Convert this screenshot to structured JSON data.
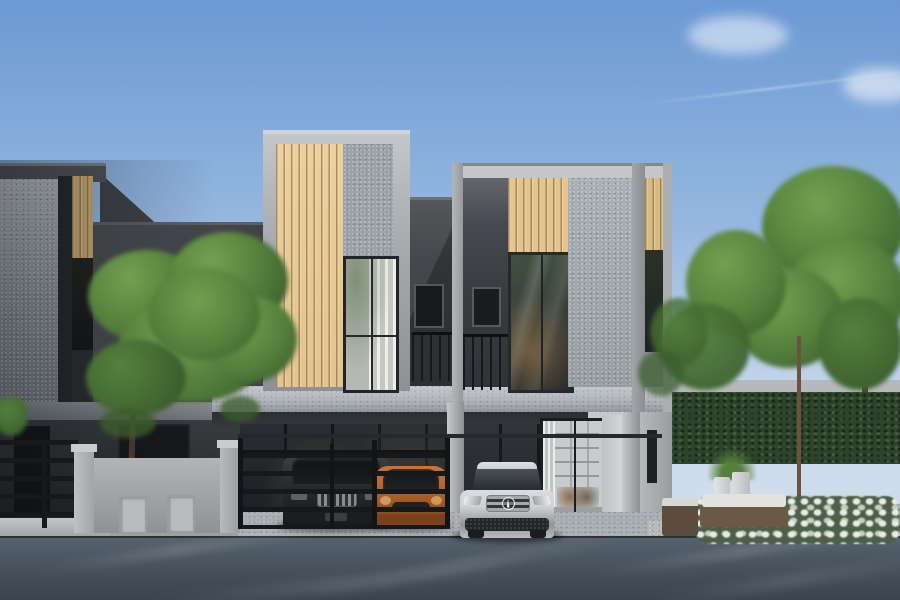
{
  "scene": {
    "description": "Photorealistic 3D architectural rendering of modern two-storey townhouses with grey speckled concrete facades and tan vertical wood-slat accent panels; three cars (dark SUV, orange hatchback, silver Mercedes) parked in front behind a black rail fence and grey gate wall; a small tree in the left front yard; hedge, flowering shrubs, planters and garden sofa on the right; asphalt road in the foreground under a blue sky with light clouds",
    "elements": [
      "sky",
      "clouds",
      "contrail",
      "left-townhouse-unit",
      "center-accent-box",
      "right-townhouse-unit",
      "wood-slat-panels",
      "speckled-concrete-panels",
      "balcony-railings",
      "upper-windows",
      "floor-slab-band",
      "ground-floor-glass",
      "glass-entry-door",
      "front-tree",
      "black-rail-fence",
      "grey-gate-wall",
      "dark-suv",
      "orange-hatchback",
      "silver-mercedes",
      "hedge",
      "garden-trees",
      "flower-bed",
      "planters",
      "outdoor-sofa",
      "curb",
      "driveway-apron",
      "asphalt-road"
    ]
  },
  "palette": {
    "sky_top": "#6b99d3",
    "sky_mid": "#96b8e0",
    "sky_horizon": "#cfdceb",
    "cloud": "#f5f9fc",
    "frame_light": "#c4c7ca",
    "frame_mid": "#a9acaf",
    "frame_dark": "#8e9194",
    "speckle_left": "#99a0a6",
    "speckle_center": "#9ba3a9",
    "speckle_right": "#a9b0b5",
    "wood_center": "#ecd0a0",
    "wood_left": "#c9a872",
    "wood_right": "#e4c48f",
    "wood_edge": "#d9ba85",
    "dark_wall": "#45484c",
    "dark_wall_deep": "#34373b",
    "frame_black": "#26292c",
    "glass_dark": "#17191c",
    "glass_green": "#41503f",
    "curtain_light": "#e9e9e4",
    "curtain_shade": "#c9cac3",
    "slab_light": "#c3c7cb",
    "slab_shadow": "#8e9499",
    "soffit": "#2b2e31",
    "white_wall": "#d4d6d8",
    "column_light": "#c7cacc",
    "column_dark": "#8d9093",
    "fence_dark": "#16181a",
    "gate_wall": "#b2b4b6",
    "gate_wall_dark": "#8f9295",
    "gate_cap": "#c9cbcd",
    "hedge": "#2e432c",
    "foliage": "#55803c",
    "foliage_light": "#72a050",
    "foliage_dark": "#3b5e2d",
    "trunk": "#6d523d",
    "flower": "#e7ede5",
    "flower_shade": "#c2d1be",
    "flower_base": "#4e5f49",
    "road": "#49545f",
    "road_dark": "#39434e",
    "road_light": "#616d79",
    "curb": "#c4c7c9",
    "apron": "#a7acb1",
    "gravel": "#b5b9b5",
    "suv_body": "#27292c",
    "chrome": "#888c8f",
    "car_orange": "#b06227",
    "car_orange_dark": "#7a421c",
    "silver": "#cdd1d4",
    "silver_dark": "#909497",
    "glass_tint": "#2b3034",
    "interior_warm": "#8a6f4e",
    "interior_white": "#c9ccce"
  }
}
